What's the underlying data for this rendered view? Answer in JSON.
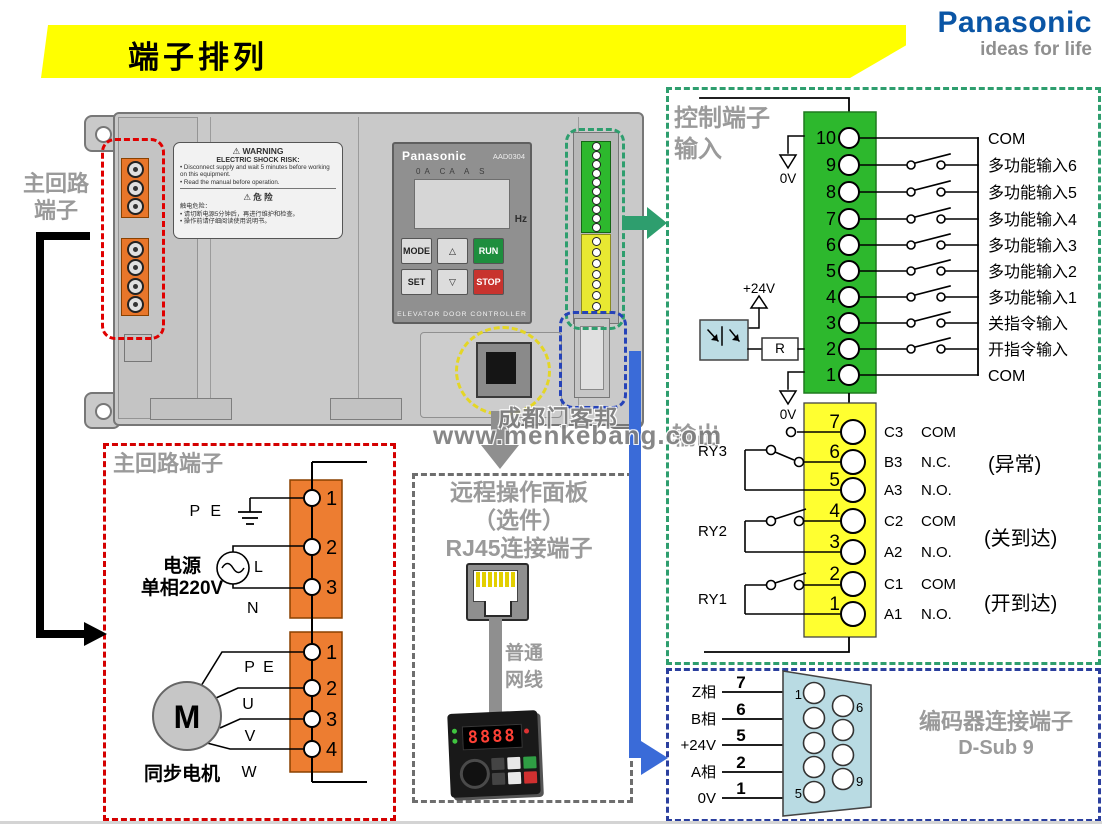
{
  "header": {
    "title": "端子排列",
    "brand": "Panasonic",
    "tagline": "ideas for life"
  },
  "watermark": {
    "line1": "成都门客邦",
    "line2": "www.menkebang.com"
  },
  "left_label": {
    "line1": "主回路",
    "line2": "端子"
  },
  "device": {
    "brand": "Panasonic",
    "model": "AAD0304",
    "indicators": "0A CA A S",
    "display_unit": "Hz",
    "buttons": [
      "MODE",
      "△",
      "RUN",
      "SET",
      "▽",
      "STOP"
    ],
    "footer_text": "ELEVATOR DOOR CONTROLLER",
    "warning": {
      "title": "⚠ WARNING",
      "line1": "ELECTRIC SHOCK RISK:",
      "line2": "• Disconnect supply and wait 5 minutes before working on this equipment.",
      "line3": "• Read the manual before operation.",
      "cn_title": "⚠ 危 险",
      "cn_line1": "触电危险：",
      "cn_line2": "• 请切断电源5分钟后，再进行维护和检查。",
      "cn_line3": "• 操作前请仔细阅读使用说明书。"
    }
  },
  "control_inputs": {
    "title_line1": "控制端子",
    "title_line2": "输入",
    "ov": "0V",
    "plus24": "+24V",
    "resistor": "R",
    "terminals": [
      {
        "num": "10",
        "label": "COM"
      },
      {
        "num": "9",
        "label": "多功能输入6"
      },
      {
        "num": "8",
        "label": "多功能输入5"
      },
      {
        "num": "7",
        "label": "多功能输入4"
      },
      {
        "num": "6",
        "label": "多功能输入3"
      },
      {
        "num": "5",
        "label": "多功能输入2"
      },
      {
        "num": "4",
        "label": "多功能输入1"
      },
      {
        "num": "3",
        "label": "关指令输入"
      },
      {
        "num": "2",
        "label": "开指令输入"
      },
      {
        "num": "1",
        "label": "COM"
      }
    ]
  },
  "outputs": {
    "title": "输出",
    "relays": [
      "RY3",
      "RY2",
      "RY1"
    ],
    "terminals": [
      {
        "num": "7",
        "code": "C3",
        "type": "COM"
      },
      {
        "num": "6",
        "code": "B3",
        "type": "N.C."
      },
      {
        "num": "5",
        "code": "A3",
        "type": "N.O."
      },
      {
        "num": "4",
        "code": "C2",
        "type": "COM"
      },
      {
        "num": "3",
        "code": "A2",
        "type": "N.O."
      },
      {
        "num": "2",
        "code": "C1",
        "type": "COM"
      },
      {
        "num": "1",
        "code": "A1",
        "type": "N.O."
      }
    ],
    "groups": [
      "(异常)",
      "(关到达)",
      "(开到达)"
    ]
  },
  "main_circuit": {
    "title": "主回路端子",
    "pe_label": "P E",
    "power_line1": "电源",
    "power_line2": "单相220V",
    "line_l": "L",
    "line_n": "N",
    "power_terminals": [
      "1",
      "2",
      "3"
    ],
    "motor_letter": "M",
    "motor_name": "同步电机",
    "motor_wires": [
      "P E",
      "U",
      "V",
      "W"
    ],
    "motor_terminals": [
      "1",
      "2",
      "3",
      "4"
    ]
  },
  "remote": {
    "title_line1": "远程操作面板",
    "title_line2": "（选件）",
    "title_line3": "RJ45连接端子",
    "cable_line1": "普通",
    "cable_line2": "网线",
    "display": "8888"
  },
  "encoder": {
    "title_line1": "编码器连接端子",
    "title_line2": "D-Sub 9",
    "pins": [
      {
        "label": "Z相",
        "num": "7"
      },
      {
        "label": "B相",
        "num": "6"
      },
      {
        "label": "+24V",
        "num": "5"
      },
      {
        "label": "A相",
        "num": "2"
      },
      {
        "label": "0V",
        "num": "1"
      }
    ],
    "corners": {
      "tl": "1",
      "tr": "6",
      "bl": "5",
      "br": "9"
    }
  }
}
